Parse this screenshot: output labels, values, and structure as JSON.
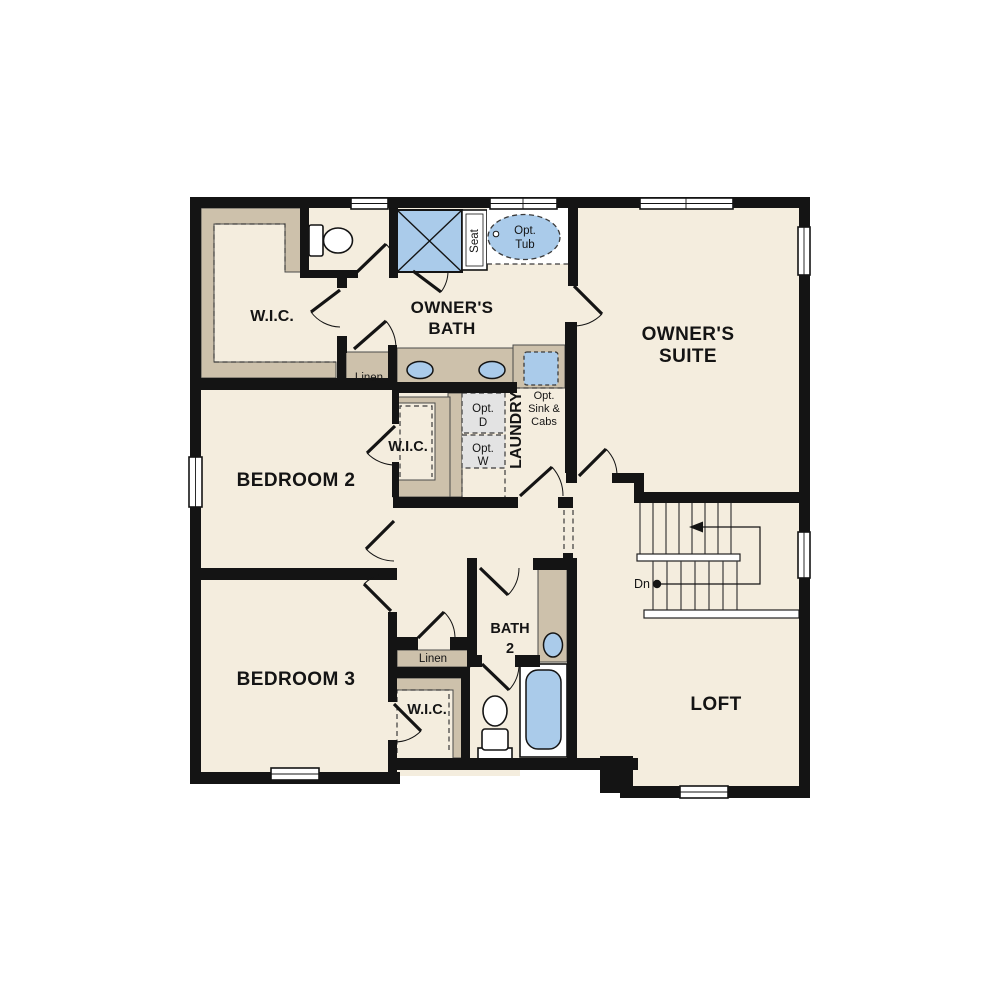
{
  "colors": {
    "wall": "#141414",
    "floor": "#f4edde",
    "cabinet_tan": "#cdc1ab",
    "fixture_blue": "#aacbea",
    "optional_gray": "#e3e3e3",
    "background": "#ffffff"
  },
  "rooms": {
    "owners_suite": {
      "line1": "OWNER'S",
      "line2": "SUITE"
    },
    "owners_bath": {
      "line1": "OWNER'S",
      "line2": "BATH"
    },
    "owners_wic": {
      "label": "W.I.C."
    },
    "bedroom2": {
      "label": "BEDROOM 2"
    },
    "bedroom3": {
      "label": "BEDROOM 3"
    },
    "loft": {
      "label": "LOFT"
    },
    "bath2": {
      "line1": "BATH",
      "line2": "2"
    },
    "wic_bedroom2": {
      "label": "W.I.C."
    },
    "wic_bedroom3": {
      "label": "W.I.C."
    },
    "laundry": {
      "label": "LAUNDRY"
    }
  },
  "annotations": {
    "linen_upper": "Linen",
    "linen_lower": "Linen",
    "seat": "Seat",
    "opt_tub": {
      "line1": "Opt.",
      "line2": "Tub"
    },
    "opt_dryer": {
      "line1": "Opt.",
      "line2": "D"
    },
    "opt_washer": {
      "line1": "Opt.",
      "line2": "W"
    },
    "opt_sink_cabs": {
      "line1": "Opt.",
      "line2": "Sink &",
      "line3": "Cabs"
    },
    "stairs_down": "Dn"
  }
}
